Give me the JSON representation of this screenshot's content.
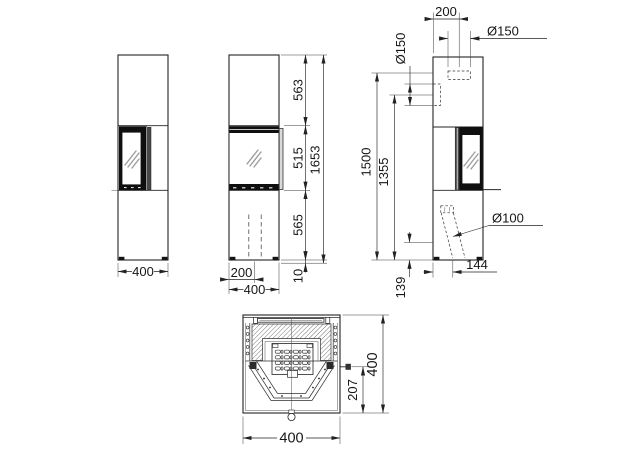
{
  "drawing": {
    "views": {
      "side_a": {
        "width": "400"
      },
      "front": {
        "section_heights": [
          "563",
          "515",
          "565"
        ],
        "total_height": "1653",
        "base_height": "10",
        "duct_offset": "200",
        "width": "400"
      },
      "side_b": {
        "flue_top_offset": "200",
        "flue_top_diameter": "Ø150",
        "flue_rear_diameter": "Ø150",
        "flue_top_height": "1500",
        "flue_rear_height": "1355",
        "air_intake_diameter": "Ø100",
        "air_intake_offset": "144",
        "air_intake_height": "139"
      },
      "plan": {
        "damper_offset": "207",
        "depth": "400",
        "width": "400"
      }
    }
  }
}
